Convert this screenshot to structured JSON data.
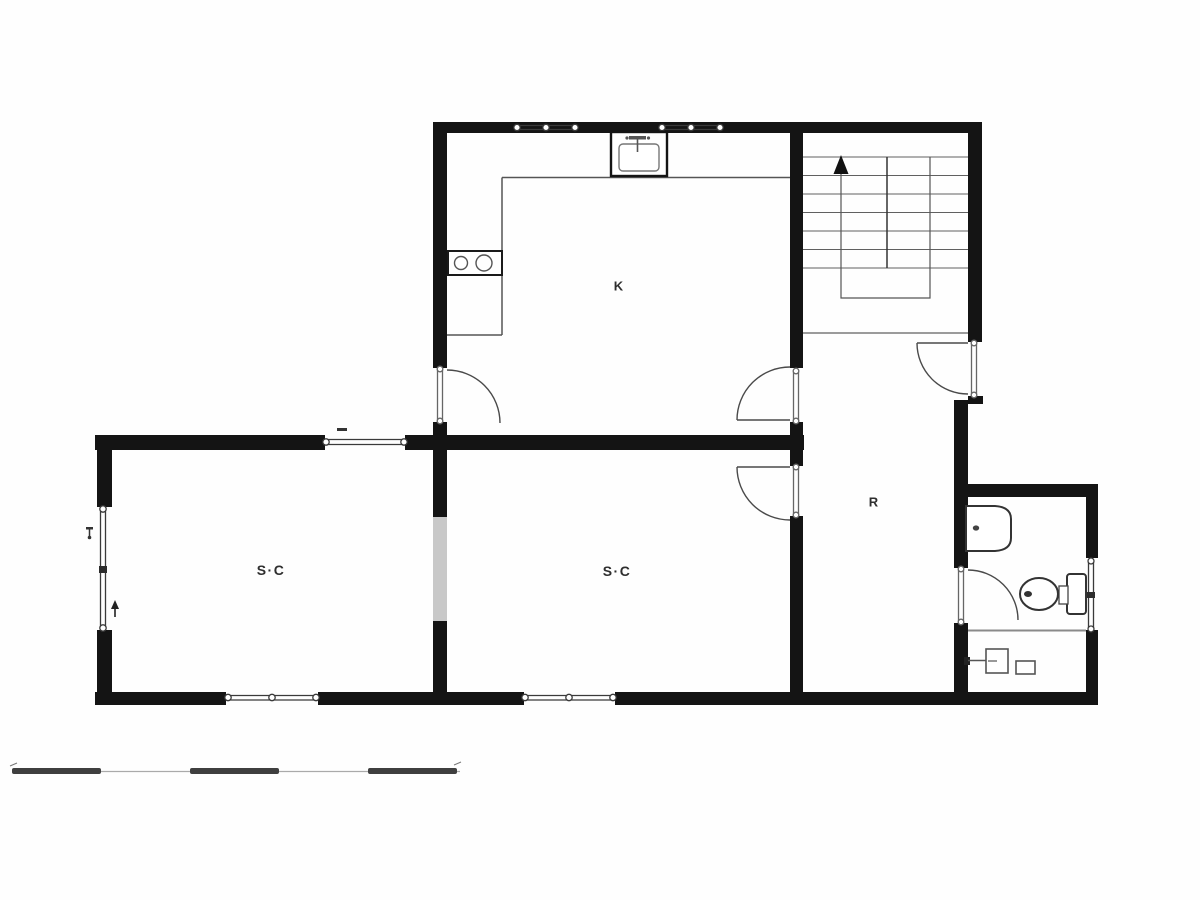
{
  "document": {
    "type": "architectural floor plan",
    "description": "Black-and-white apartment floor plan with kitchen, two rooms, hall, stair and bathroom"
  },
  "rooms": [
    {
      "id": "kitchen",
      "label": "K"
    },
    {
      "id": "room-1",
      "label": "S·C"
    },
    {
      "id": "room-2",
      "label": "S·C"
    },
    {
      "id": "hall",
      "label": "R"
    }
  ],
  "symbols": {
    "stair": "staircase-with-up-arrow",
    "kitchen_fixtures": [
      "sink",
      "stove-two-burners",
      "l-shaped-counter"
    ],
    "bathroom_fixtures": [
      "wash-basin",
      "toilet",
      "small-appliance-square",
      "small-appliance-rect"
    ],
    "openings": [
      "windows-double-line-with-end-circles",
      "doors-quarter-circle-swing"
    ],
    "scale_bar": "five-segment alternating bar, no text"
  },
  "colors": {
    "wall": "#141414",
    "thin_line": "#555555",
    "light_opening": "#c8c8c8",
    "background": "#fefefe",
    "label": "#2e2e2e"
  }
}
